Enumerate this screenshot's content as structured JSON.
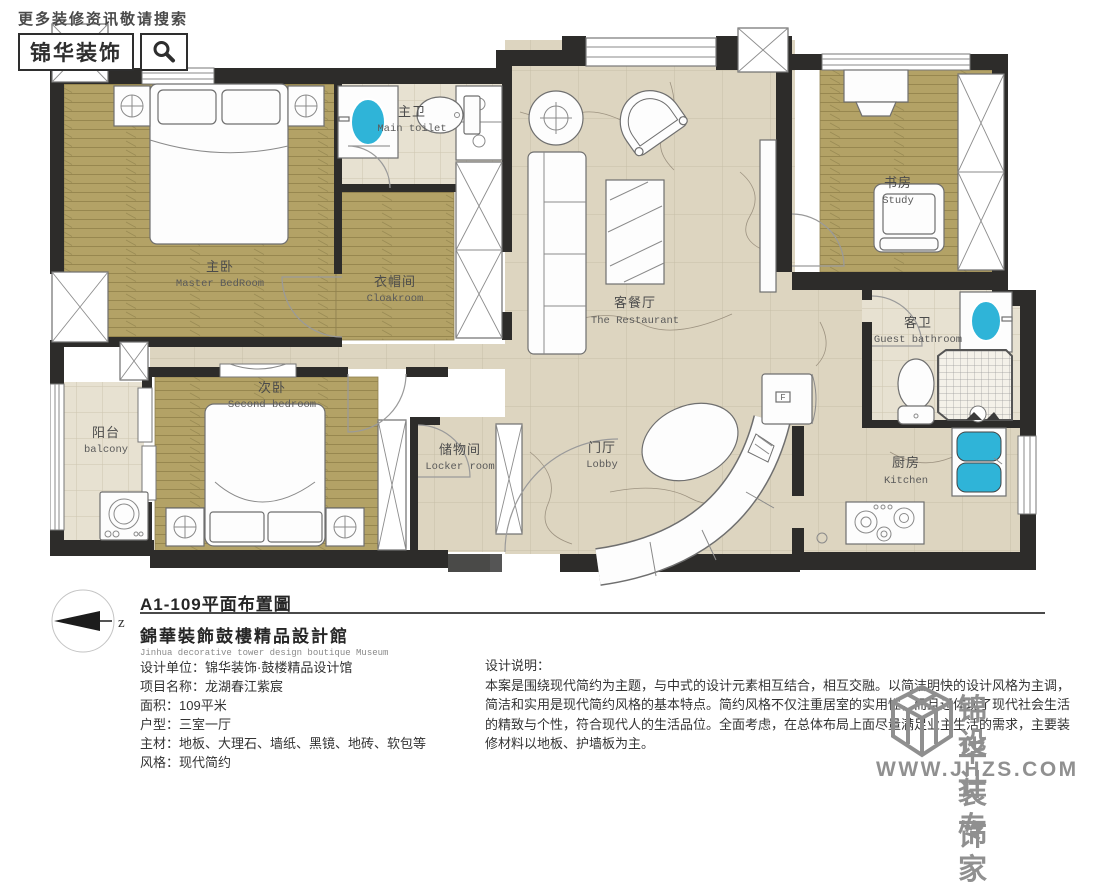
{
  "header": {
    "search_hint": "更多装修资讯敬请搜索",
    "brand": "锦华装饰"
  },
  "plan": {
    "compass_label": "z",
    "fridge_label": "F",
    "rooms": [
      {
        "id": "master-bedroom",
        "zh": "主卧",
        "en": "Master BedRoom"
      },
      {
        "id": "main-toilet",
        "zh": "主卫",
        "en": "Main toilet"
      },
      {
        "id": "cloakroom",
        "zh": "衣帽间",
        "en": "Cloakroom"
      },
      {
        "id": "study",
        "zh": "书房",
        "en": "Study"
      },
      {
        "id": "living-dining",
        "zh": "客餐厅",
        "en": "The Restaurant"
      },
      {
        "id": "guest-bathroom",
        "zh": "客卫",
        "en": "Guest bathroom"
      },
      {
        "id": "second-bedroom",
        "zh": "次卧",
        "en": "Second bedroom"
      },
      {
        "id": "balcony",
        "zh": "阳台",
        "en": "balcony"
      },
      {
        "id": "locker-room",
        "zh": "储物间",
        "en": "Locker room"
      },
      {
        "id": "lobby",
        "zh": "门厅",
        "en": "Lobby"
      },
      {
        "id": "kitchen",
        "zh": "厨房",
        "en": "Kitchen"
      }
    ]
  },
  "title_block": {
    "drawing_title": "A1-109平面布置圖",
    "studio_zh": "錦華裝飾鼓樓精品設計館",
    "studio_en": "Jinhua decorative tower design boutique Museum"
  },
  "project_info": {
    "lines": [
      "设计单位：锦华装饰·鼓楼精品设计馆",
      "项目名称：龙湖春江紫宸",
      "面积：109平米",
      "户型：三室一厅",
      "主材：地板、大理石、墙纸、黑镜、地砖、软包等",
      "风格：现代简约"
    ]
  },
  "design_notes": {
    "title": "设计说明：",
    "lines": [
      "本案是围绕现代简约为主题，与中式的设计元素相互结合，相互交融。以简洁明快的设计风格为主调，",
      "简洁和实用是现代简约风格的基本特点。简约风格不仅注重居室的实用性，而且还体现了现代社会生活",
      "的精致与个性，符合现代人的生活品位。全面考虑，在总体布局上面尽量满足业主生活的需求，主要装",
      "修材料以地板、护墙板为主。"
    ]
  },
  "watermark": {
    "brand_line1": "锦华装饰",
    "brand_line2": "设计专家",
    "url": "WWW.JHZS.COM"
  },
  "colors": {
    "wood": "#b3a266",
    "tile": "#ded6c1",
    "bath_tile": "#e7e1d1",
    "wall": "#2d2c2a",
    "fixture_blue": "#2fb4d8",
    "watermark_gray": "#909090"
  }
}
